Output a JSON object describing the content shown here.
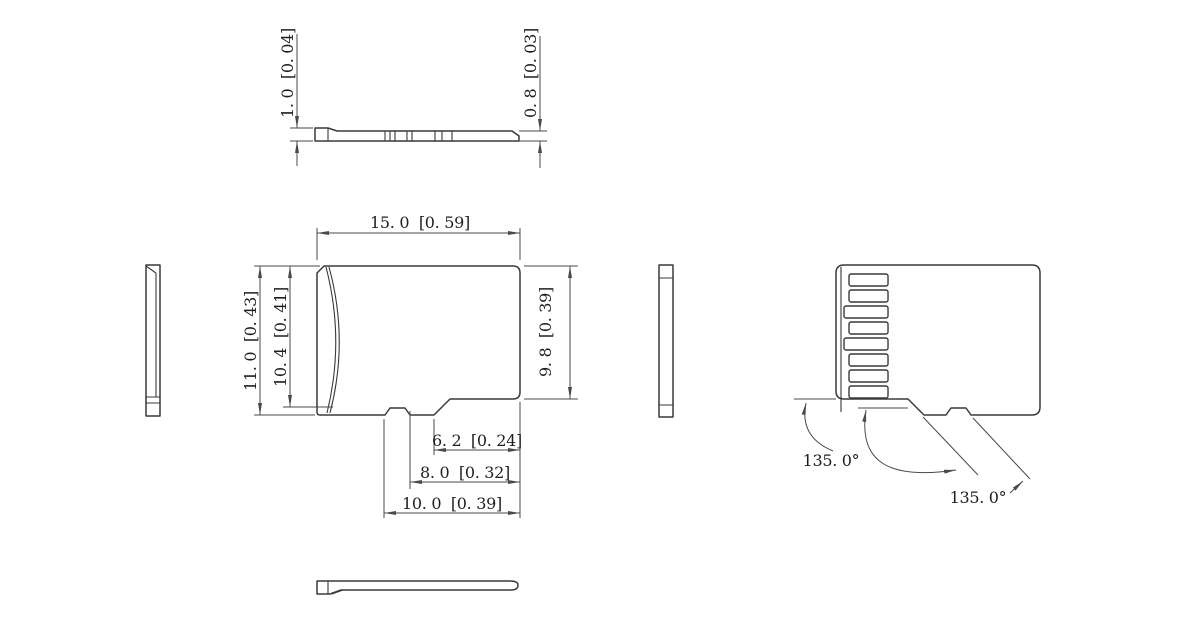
{
  "colors": {
    "background": "#ffffff",
    "line": "#3a3a3a",
    "dimension_line": "#4a4a4a",
    "text": "#1e1e1e"
  },
  "dims": {
    "width": "15. 0  [0. 59]",
    "height": "11. 0  [0. 43]",
    "height_ridge": "10. 4  [0. 41]",
    "height_right": "9. 8  [0. 39]",
    "thickness_max": "1. 0  [0. 04]",
    "thickness_min": "0. 8  [0. 03]",
    "notch_a": "6. 2  [0. 24]",
    "notch_b": "8. 0  [0. 32]",
    "notch_c": "10. 0  [0. 39]",
    "angle_front": "135. 0°",
    "angle_rear": "135. 0°"
  },
  "back_view": {
    "contact_pad_count": 8
  }
}
